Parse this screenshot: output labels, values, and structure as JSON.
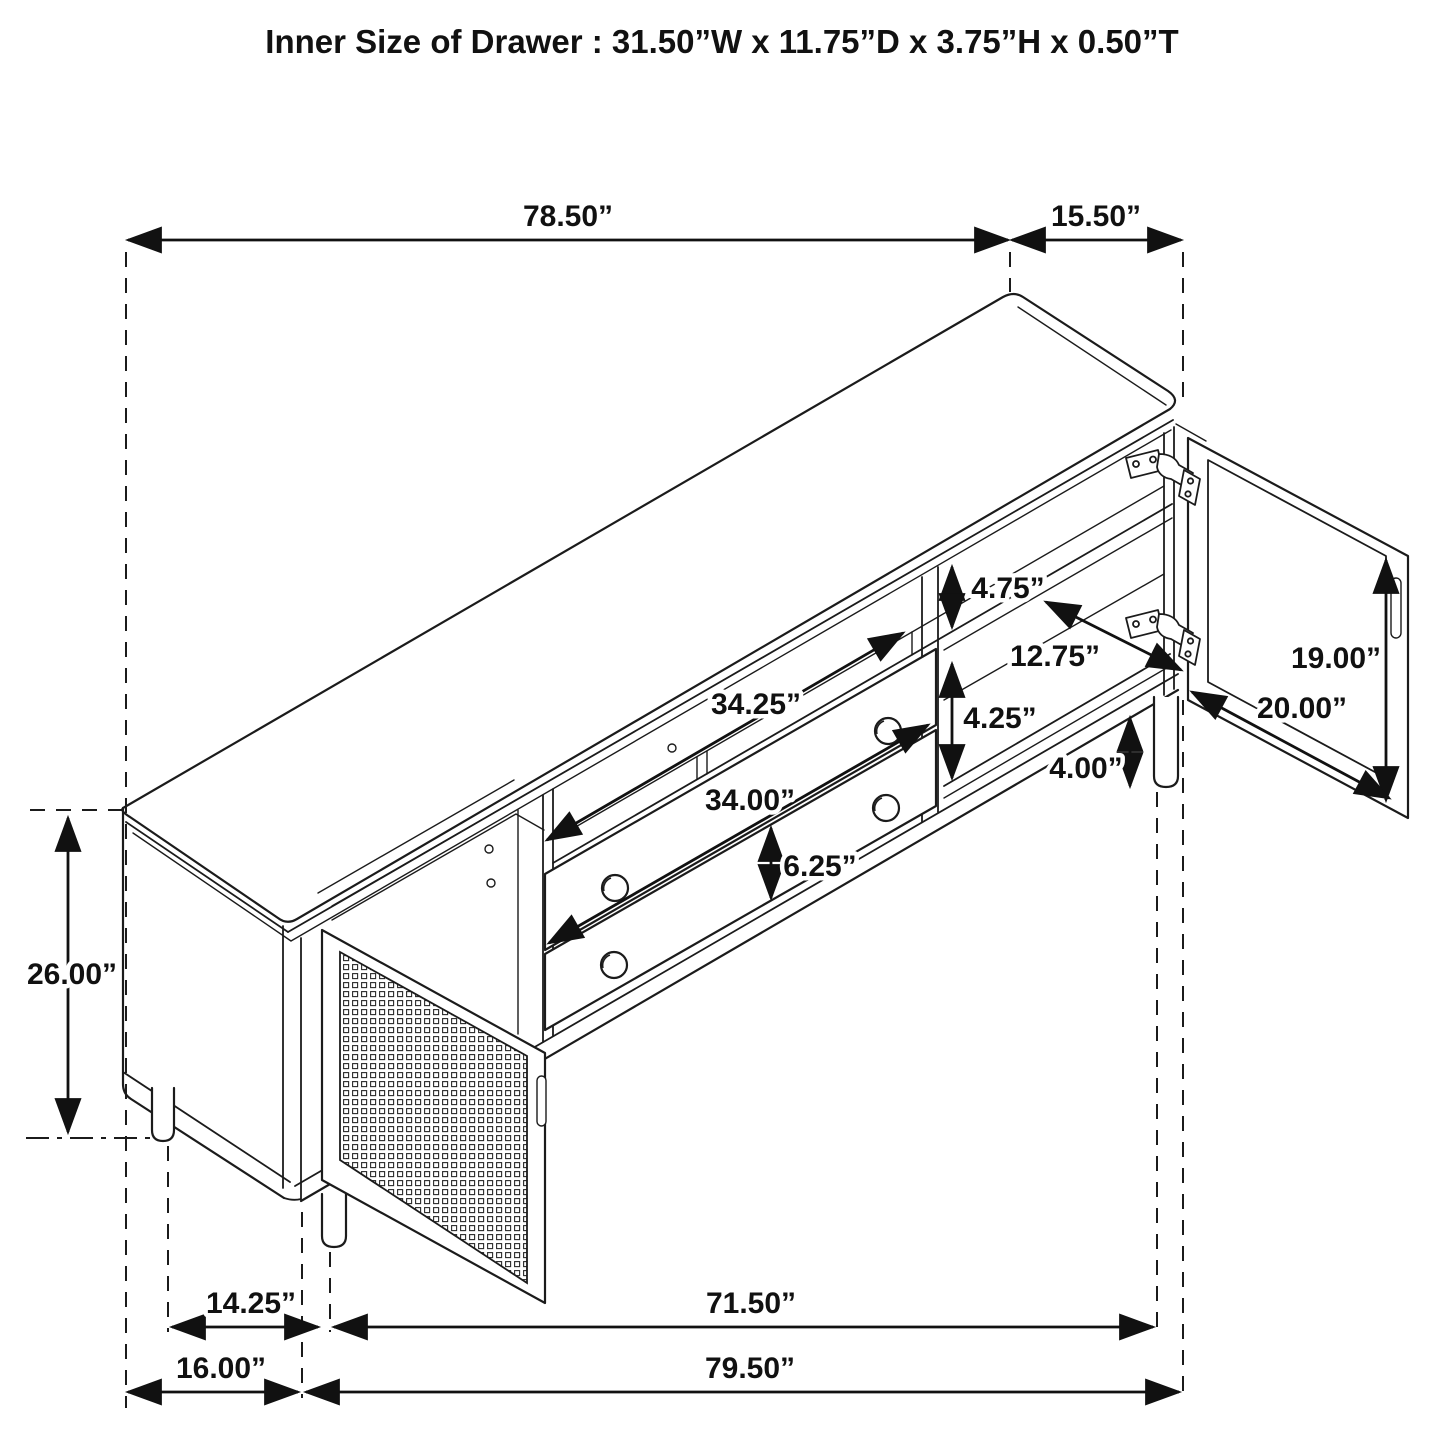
{
  "title": "Inner Size of Drawer : 31.50”W x 11.75”D x 3.75”H x 0.50”T",
  "colors": {
    "line": "#1b1b1b",
    "background": "#ffffff"
  },
  "dimensions": {
    "top_width": "78.50”",
    "top_side_depth": "15.50”",
    "overall_height": "26.00”",
    "shelf_opening_height": "4.75”",
    "compartment_depth": "12.75”",
    "compartment_opening_height": "4.25”",
    "door_opening_height": "19.00”",
    "door_width": "20.00”",
    "leg_height": "4.00”",
    "top_drawer_width": "34.25”",
    "bottom_drawer_width": "34.00”",
    "drawer_front_height": "6.25”",
    "side_leg_spacing": "14.25”",
    "base_width": "71.50”",
    "side_depth_bottom": "16.00”",
    "overall_base_width": "79.50”"
  }
}
